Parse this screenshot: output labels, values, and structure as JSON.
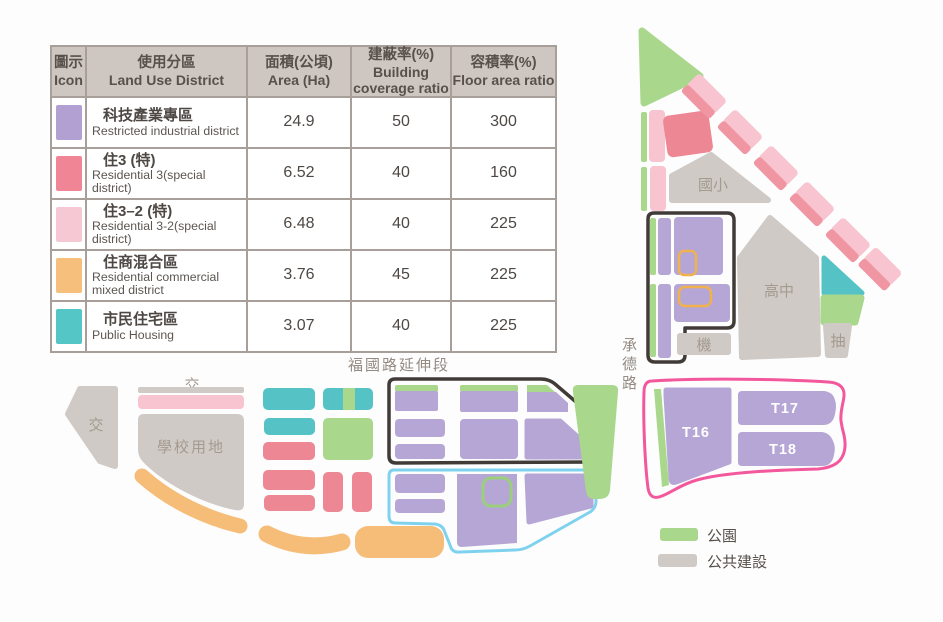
{
  "colors": {
    "purple": "#b5a6d5",
    "red": "#ed8794",
    "pink": "#f7c4cf",
    "pink_stripe": "#ef96a2",
    "orange": "#f6bd78",
    "teal": "#55c3c6",
    "green": "#a9d78c",
    "gray": "#d0cac6",
    "outline_black": "#413b38",
    "outline_pink": "#f3589c",
    "outline_blue": "#7fd2ee",
    "outline_orange": "#f1b24d",
    "outline_green": "#9bce7d",
    "header_bg": "#cdc6c1",
    "table_border": "#a99f9a",
    "text_header": "#57504b",
    "text_table": "#4e4844",
    "text_map": "#a39a90",
    "text_road": "#948a82",
    "text_legend": "#564f4a"
  },
  "table": {
    "headers": [
      {
        "zh": "圖示",
        "en": "Icon"
      },
      {
        "zh": "使用分區",
        "en": "Land Use District"
      },
      {
        "zh": "面積(公頃)",
        "en": "Area (Ha)"
      },
      {
        "zh": "建蔽率(%)",
        "en": "Building coverage ratio"
      },
      {
        "zh": "容積率(%)",
        "en": "Floor area ratio"
      }
    ],
    "rows": [
      {
        "color": "#b2a0d2",
        "zh": "科技產業專區",
        "en": "Restricted industrial district",
        "area": "24.9",
        "bcr": "50",
        "far": "300"
      },
      {
        "color": "#ef8595",
        "zh": "住3 (特)",
        "en": "Residential 3(special district)",
        "area": "6.52",
        "bcr": "40",
        "far": "160"
      },
      {
        "color": "#f6c8d4",
        "zh": "住3–2 (特)",
        "en": "Residential 3-2(special district)",
        "area": "6.48",
        "bcr": "40",
        "far": "225"
      },
      {
        "color": "#f6bf7b",
        "zh": "住商混合區",
        "en": "Residential commercial mixed district",
        "area": "3.76",
        "bcr": "45",
        "far": "225"
      },
      {
        "color": "#54c6c5",
        "zh": "市民住宅區",
        "en": "Public Housing",
        "area": "3.07",
        "bcr": "40",
        "far": "225"
      }
    ]
  },
  "map": {
    "labels": {
      "elementary_school": "國小",
      "high_school": "高中",
      "machine": "機",
      "pump": "抽",
      "chengde_road": "承德路",
      "fuguo_road": "福國路延伸段",
      "interchange_top": "交",
      "interchange_left": "交",
      "school_land": "學校用地",
      "t16": "T16",
      "t17": "T17",
      "t18": "T18"
    },
    "legend": [
      {
        "label": "公園",
        "color": "#a9d78c"
      },
      {
        "label": "公共建設",
        "color": "#d0cac6"
      }
    ]
  }
}
